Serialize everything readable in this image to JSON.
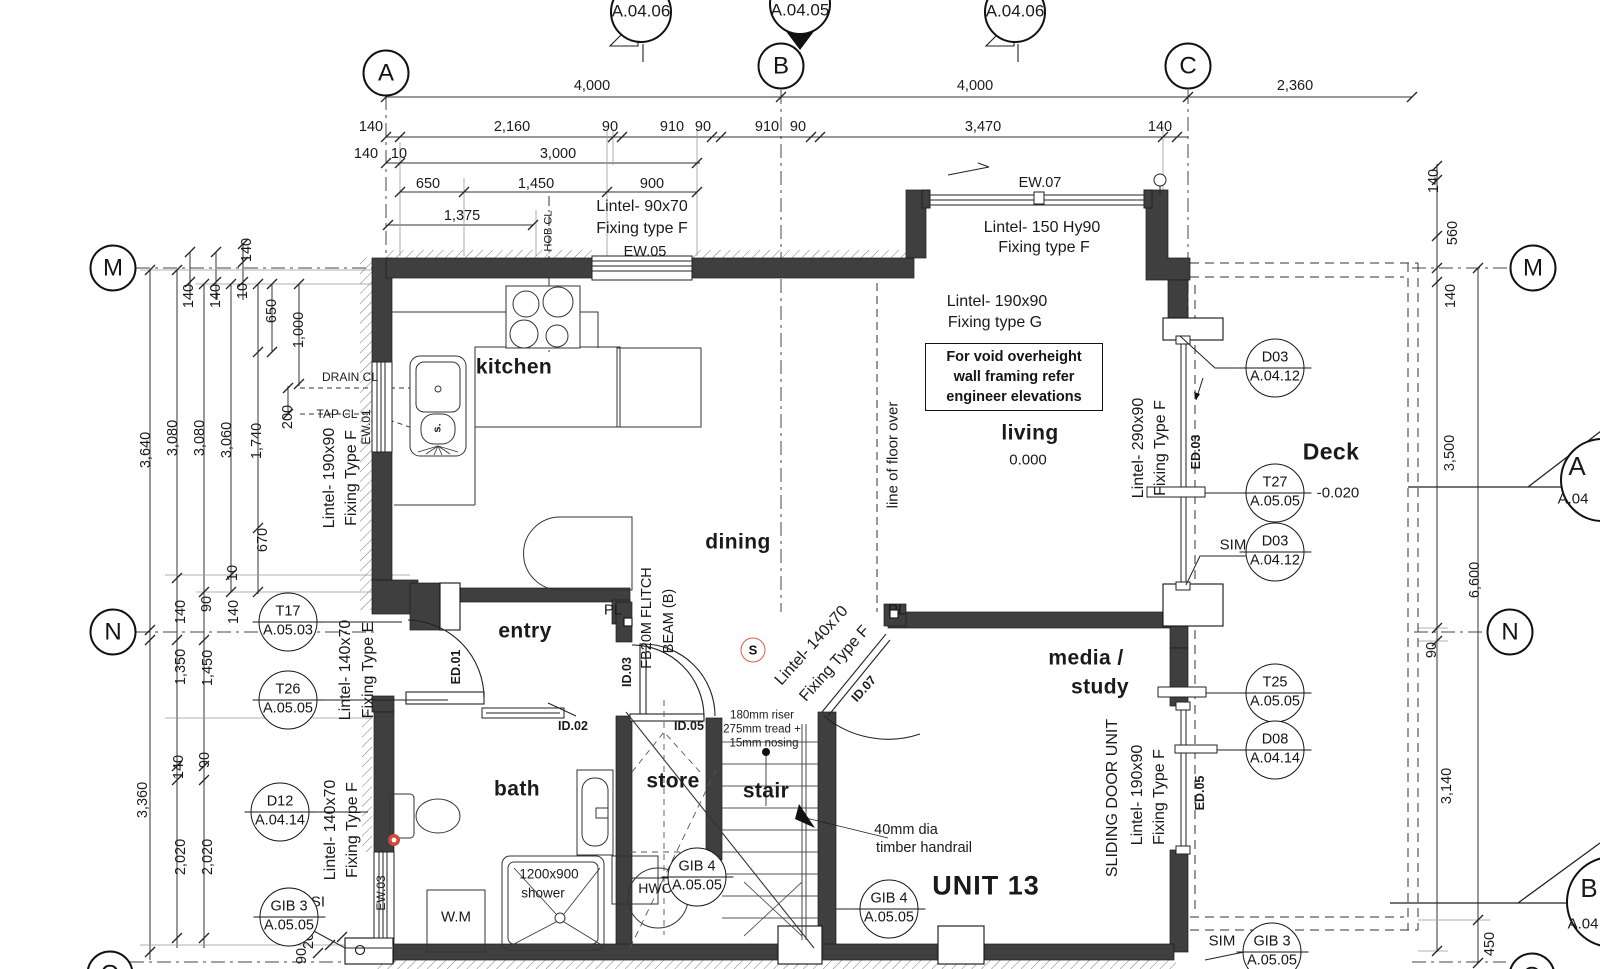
{
  "drawing": {
    "unit": "UNIT 13",
    "grid": {
      "A": "A",
      "B": "B",
      "C": "C",
      "M": "M",
      "N": "N",
      "Q": "Q"
    },
    "sections": {
      "top_left": "A.04.06",
      "top_center": "A.04.05",
      "top_right": "A.04.06",
      "right_upper_letter": "A",
      "right_upper_sheet": "A.04",
      "right_lower_letter": "B",
      "right_lower_sheet": "A.04"
    },
    "rooms": {
      "kitchen": "kitchen",
      "dining": "dining",
      "living": "living",
      "entry": "entry",
      "bath": "bath",
      "store": "store",
      "stair": "stair",
      "media1": "media /",
      "media2": "study",
      "deck": "Deck"
    },
    "levels": {
      "living": "0.000",
      "deck": "-0.020"
    },
    "fixtures": {
      "wm": "W.M",
      "shower1": "1200x900",
      "shower2": "shower",
      "hwc": "HWC",
      "sink": "s."
    },
    "openings": {
      "ew01": "EW.01",
      "ew03": "EW.03",
      "ew05": "EW.05",
      "ew07": "EW.07",
      "ed01": "ED.01",
      "ed03": "ED.03",
      "ed05": "ED.05",
      "id02": "ID.02",
      "id03": "ID.03",
      "id05": "ID.05",
      "id07": "ID.07"
    },
    "notes": {
      "void1": "For void overheight",
      "void2": "wall framing refer",
      "void3": "engineer elevations",
      "floor_over": "line of floor over",
      "riser1": "180mm riser",
      "riser2": "275mm tread +",
      "riser3": "15mm nosing",
      "handrail1": "40mm dia",
      "handrail2": "timber handrail",
      "flitch1": "FB20M FLITCH",
      "flitch2": "BEAM (B)",
      "pl": "PL",
      "s": "S",
      "sim": "SIM",
      "si": "SI",
      "hob": "HOB CL",
      "drain": "DRAIN CL",
      "tap": "TAP CL"
    },
    "lintels": {
      "ew05a": "Lintel- 90x70",
      "ew05b": "Fixing type F",
      "ew07a": "Lintel- 150 Hy90",
      "ew07b": "Fixing type F",
      "livinga": "Lintel- 190x90",
      "livingb": "Fixing type G",
      "lefta": "Lintel- 190x90",
      "leftb": "Fixing Type F",
      "entrya": "Lintel- 140x70",
      "entryb": "Fixing Type E",
      "batha": "Lintel- 140x70",
      "bathb": "Fixing Type F",
      "decka": "Lintel- 290x90",
      "deckb": "Fixing Type F",
      "slider0": "SLIDING DOOR UNIT",
      "slider1": "Lintel- 190x90",
      "slider2": "Fixing Type F",
      "diaga": "Lintel- 140x70",
      "diagb": "Fixing Type F"
    },
    "tags": [
      {
        "code": "T17",
        "sheet": "A.05.03"
      },
      {
        "code": "T26",
        "sheet": "A.05.05"
      },
      {
        "code": "D12",
        "sheet": "A.04.14"
      },
      {
        "code": "GIB 3",
        "sheet": "A.05.05"
      },
      {
        "code": "D03",
        "sheet": "A.04.12"
      },
      {
        "code": "T27",
        "sheet": "A.05.05"
      },
      {
        "code": "D03",
        "sheet": "A.04.12"
      },
      {
        "code": "T25",
        "sheet": "A.05.05"
      },
      {
        "code": "D08",
        "sheet": "A.04.14"
      },
      {
        "code": "GIB 4",
        "sheet": "A.05.05"
      },
      {
        "code": "GIB 4",
        "sheet": "A.05.05"
      },
      {
        "code": "GIB 3",
        "sheet": "A.05.05"
      }
    ],
    "dims": {
      "row1": [
        "4,000",
        "4,000",
        "2,360"
      ],
      "row2": [
        "140",
        "2,160",
        "90",
        "910",
        "90",
        "910",
        "90",
        "3,470",
        "140"
      ],
      "row3": [
        "140",
        "10",
        "3,000"
      ],
      "row4": [
        "650",
        "1,450",
        "900"
      ],
      "row5": [
        "1,375"
      ],
      "left": [
        "140",
        "140",
        "10",
        "140",
        "650",
        "1,000",
        "200",
        "3,640",
        "3,080",
        "3,080",
        "3,060",
        "1,740",
        "670",
        "10",
        "140",
        "90",
        "140",
        "1,350",
        "1,450",
        "140",
        "90",
        "3,360",
        "2,020",
        "2,020"
      ],
      "bottom": [
        "20",
        "90"
      ],
      "right": [
        "140",
        "560",
        "140",
        "3,500",
        "6,600",
        "90",
        "3,140",
        "450"
      ]
    }
  }
}
